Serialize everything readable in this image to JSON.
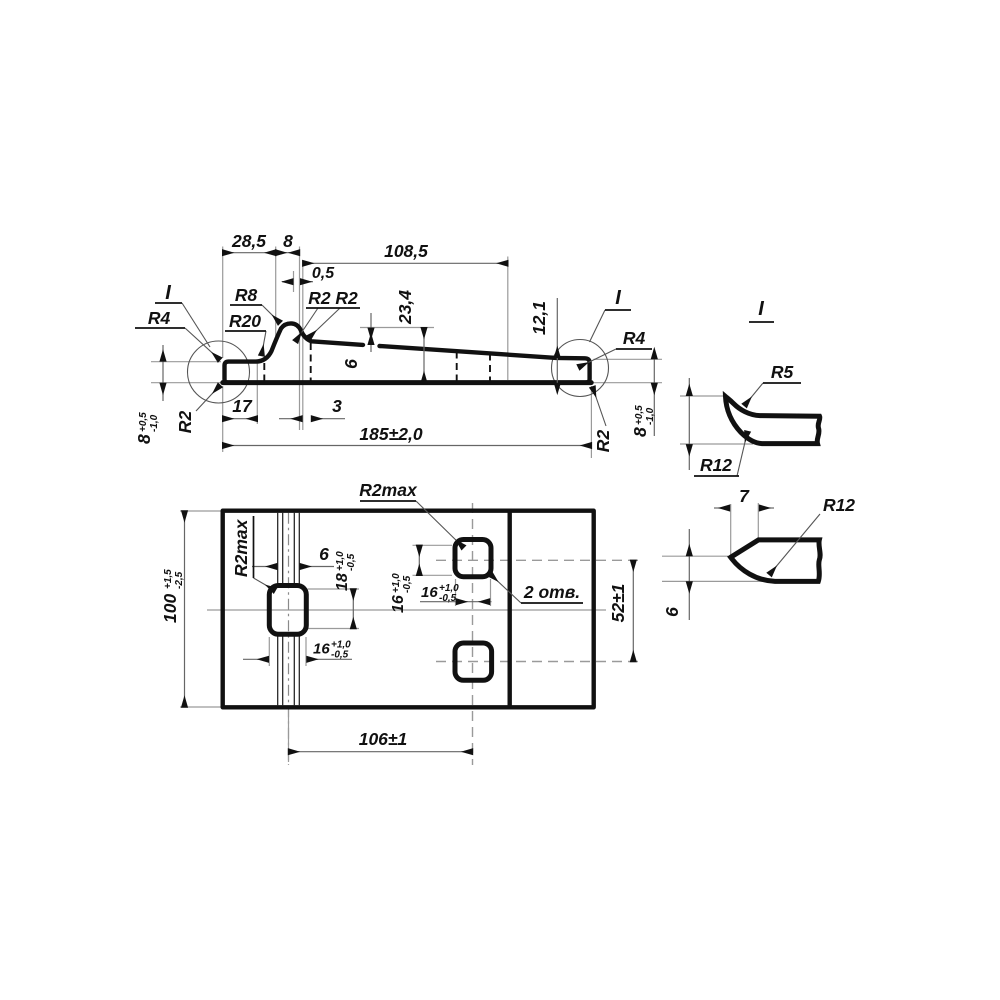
{
  "top_view": {
    "dim_28_5": "28,5",
    "dim_8": "8",
    "dim_108_5": "108,5",
    "dim_0_5": "0,5",
    "dim_23_4": "23,4",
    "dim_6": "6",
    "dim_12_1": "12,1",
    "dim_17": "17",
    "dim_3": "3",
    "dim_185": "185±2,0",
    "radius_r4_left": "R4",
    "radius_r20": "R20",
    "radius_r8": "R8",
    "radius_r2_r2": "R2 R2",
    "radius_r2_left": "R2",
    "radius_r2_right": "R2",
    "radius_r4_right": "R4",
    "detail_mark_left": "I",
    "detail_mark_right": "I",
    "thickness": "8",
    "thickness_plus": "+0,5",
    "thickness_minus": "-1,0"
  },
  "plan_view": {
    "radius_r2max": "R2max",
    "dim_6": "6",
    "dim_18": "18",
    "dim_16": "16",
    "tol_plus": "+1,0",
    "tol_minus": "-0,5",
    "dim_52": "52±1",
    "dim_106": "106±1",
    "dim_100": "100",
    "tol_100_plus": "+1,5",
    "tol_100_minus": "-2,5",
    "holes_note": "2 отв."
  },
  "detail_views": {
    "section_label": "I",
    "radius_r5": "R5",
    "radius_r12": "R12",
    "dim_7": "7",
    "dim_6": "6"
  }
}
